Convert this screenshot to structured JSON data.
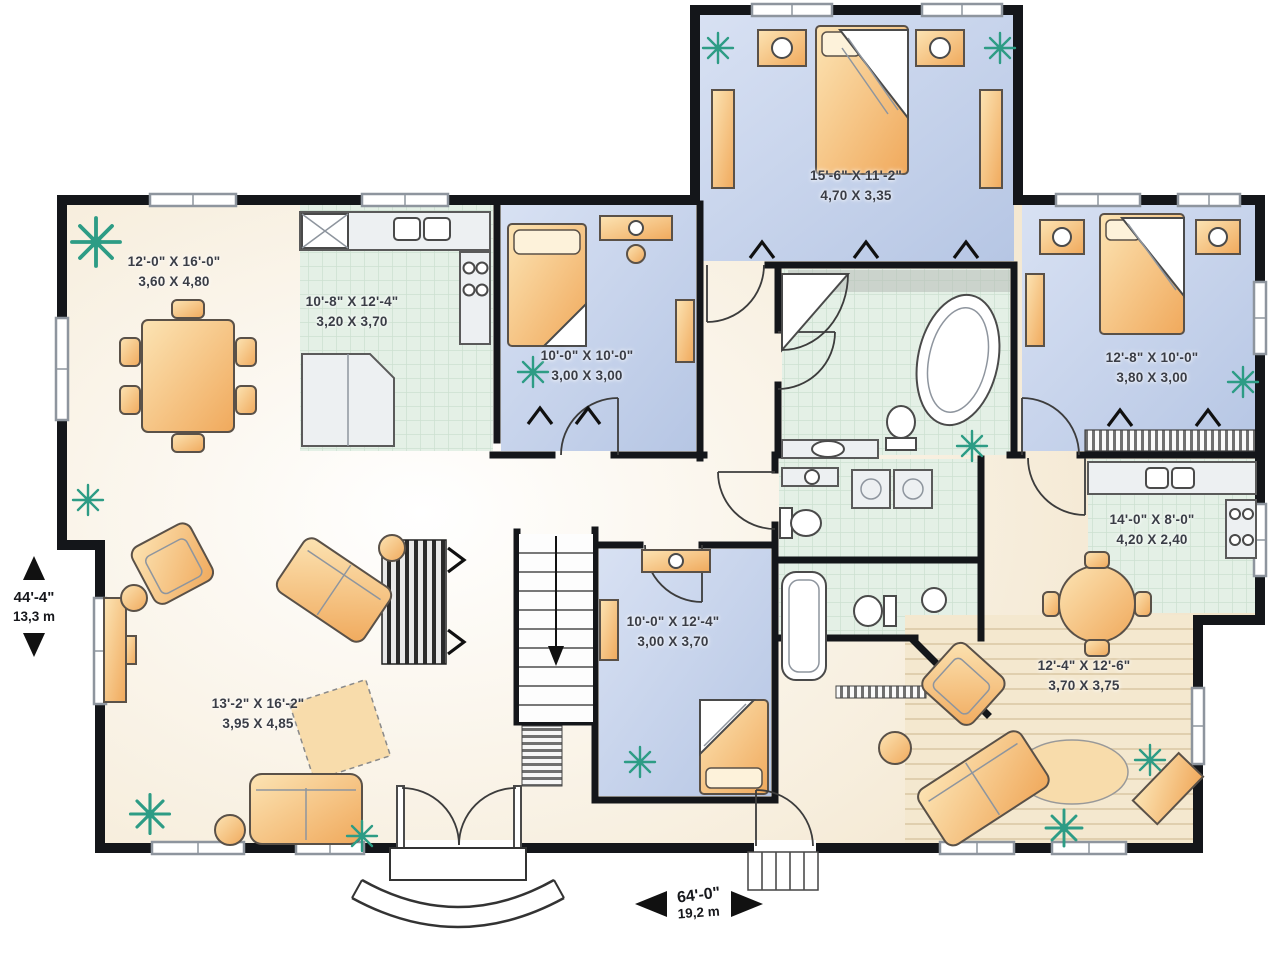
{
  "plan": {
    "type": "residential floor plan",
    "overall": {
      "height": {
        "imperial": "44'-4\"",
        "metric": "13,3 m"
      },
      "width": {
        "imperial": "64'-0\"",
        "metric": "19,2 m"
      }
    }
  },
  "rooms": [
    {
      "name": "dining-room",
      "imperial": "12'-0\" X 16'-0\"",
      "metric": "3,60 X 4,80"
    },
    {
      "name": "kitchen",
      "imperial": "10'-8\" X 12'-4\"",
      "metric": "3,20 X 3,70"
    },
    {
      "name": "bedroom-left",
      "imperial": "10'-0\" X 10'-0\"",
      "metric": "3,00 X 3,00"
    },
    {
      "name": "master-bedroom",
      "imperial": "15'-6\" X 11'-2\"",
      "metric": "4,70 X 3,35"
    },
    {
      "name": "bedroom-right",
      "imperial": "12'-8\" X 10'-0\"",
      "metric": "3,80 X 3,00"
    },
    {
      "name": "kitchen-suite",
      "imperial": "14'-0\" X 8'-0\"",
      "metric": "4,20 X 2,40"
    },
    {
      "name": "bedroom-center",
      "imperial": "10'-0\" X 12'-4\"",
      "metric": "3,00 X 3,70"
    },
    {
      "name": "living-room",
      "imperial": "13'-2\" X 16'-2\"",
      "metric": "3,95 X 4,85"
    },
    {
      "name": "family-room-suite",
      "imperial": "12'-4\" X 12'-6\"",
      "metric": "3,70 X 3,75"
    }
  ],
  "colors": {
    "wall": "#14161a",
    "bedroom_floor": "#c9d6ee",
    "tile_floor": "#e4f0e6",
    "wood_floor": "#f3e7cf",
    "beige_floor": "#eeddbd",
    "furniture": "#f7c98a",
    "plant": "#2d9c85"
  },
  "icons": {
    "plant": "starburst plant marker",
    "stairs_arrow": "down arrow",
    "dimension_arrows": "solid black triangles"
  }
}
